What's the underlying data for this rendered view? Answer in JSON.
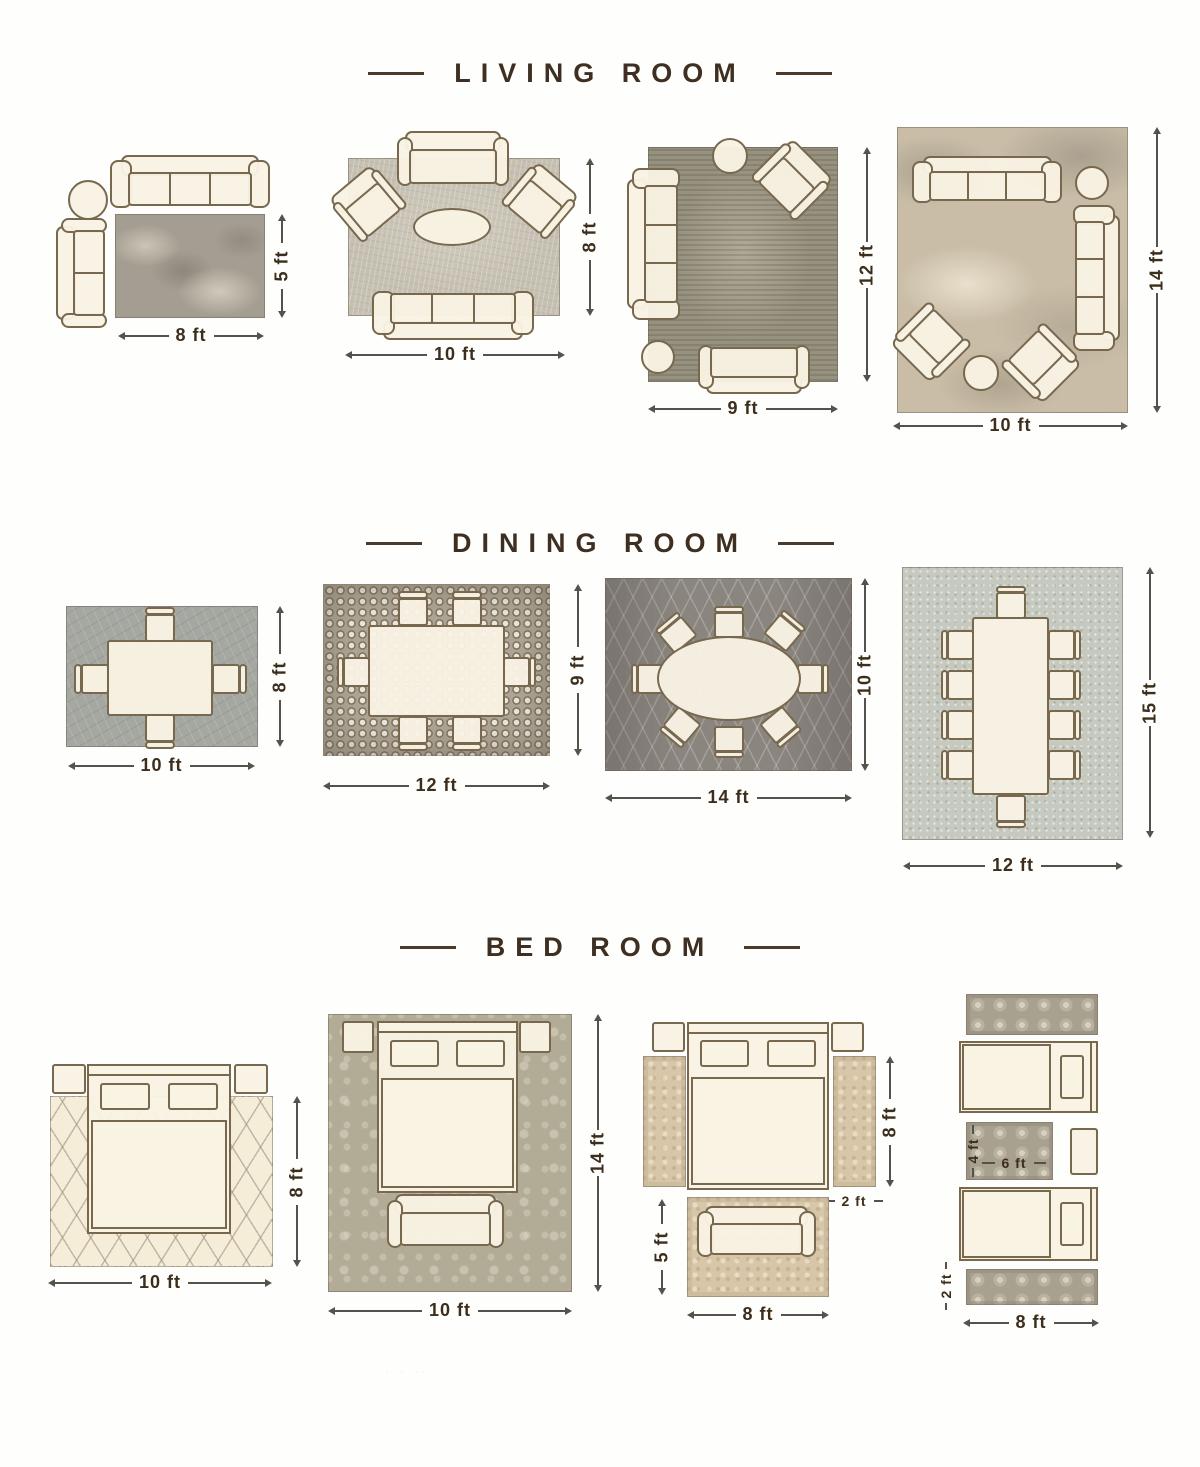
{
  "colors": {
    "background": "#fefefc",
    "title_text": "#3e2f22",
    "dimension_text": "#3c2e1d",
    "furniture_fill": "#f9f2e4",
    "furniture_outline": "#77684e"
  },
  "sections": [
    {
      "id": "living-room",
      "title": "LIVING ROOM",
      "layouts": [
        {
          "width_label": "8 ft",
          "height_label": "5 ft"
        },
        {
          "width_label": "10 ft",
          "height_label": "8 ft"
        },
        {
          "width_label": "9 ft",
          "height_label": "12 ft"
        },
        {
          "width_label": "10 ft",
          "height_label": "14 ft"
        }
      ]
    },
    {
      "id": "dining-room",
      "title": "DINING ROOM",
      "layouts": [
        {
          "width_label": "10 ft",
          "height_label": "8 ft"
        },
        {
          "width_label": "12 ft",
          "height_label": "9 ft"
        },
        {
          "width_label": "14 ft",
          "height_label": "10 ft"
        },
        {
          "width_label": "12 ft",
          "height_label": "15 ft"
        }
      ]
    },
    {
      "id": "bed-room",
      "title": "BED ROOM",
      "layouts": [
        {
          "width_label": "10 ft",
          "height_label": "8 ft"
        },
        {
          "width_label": "10 ft",
          "height_label": "14 ft"
        },
        {
          "width_label": "8 ft",
          "height_label": "8 ft",
          "runner_width_label": "2 ft",
          "foot_rug_height_label": "5 ft"
        },
        {
          "width_label": "8 ft",
          "runner_width_label": "2 ft",
          "mid_rug_width_label": "6 ft",
          "mid_rug_height_label": "4 ft"
        }
      ]
    }
  ]
}
